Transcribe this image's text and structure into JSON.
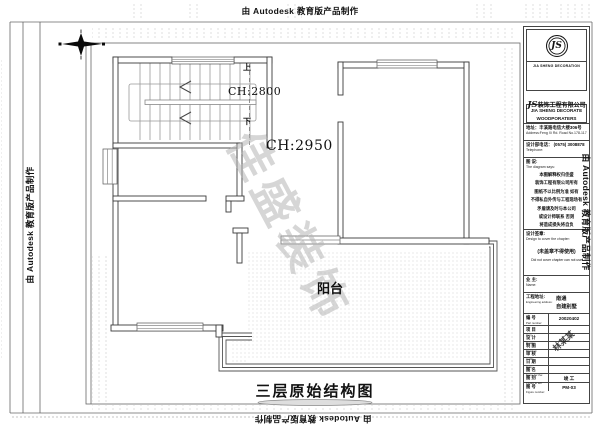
{
  "page": {
    "plot_stamp": "由 Autodesk 教育版产品制作",
    "drawing_title": "三层原始结构图"
  },
  "plan": {
    "stair_ceiling_height": "CH:2800",
    "main_ceiling_height": "CH:2950",
    "balcony_label": "阳台",
    "stair_up": "上",
    "stair_down": "下",
    "watermark": "佳盛装饰"
  },
  "title_block": {
    "logo_monogram": "JS",
    "logo_caption": "JIA SHENG DECORATION",
    "company_cn_prefix": "JS",
    "company_cn": "装饰工程有限公司",
    "company_en_line1": "JIA SHENG DECORATE",
    "company_en_line2": "WOODPORATERS",
    "address_cn": "地址：丰溪路电信大楼306号",
    "address_en": "Address:Feng Xi Rd. Road No.178-117",
    "phone_cn": "设计部电话： (0575) 3008878",
    "phone_en": "Telephone:",
    "notes_title_cn": "图 说:",
    "notes_title_en": "The diagram says:",
    "notes_lines": [
      "本图解释权归佳盛",
      "装饰工程有限公司所有",
      "图纸不以比例为准 如有",
      "不得私自外传与工程现场有",
      "矛盾请及时与本公司",
      "或设计师联系 否则",
      "将造成损失将自负"
    ],
    "seal_label_cn": "设计签章:",
    "seal_label_en": "Design to cover the chapter:",
    "seal_warning_cn": "(未盖章不得使用)",
    "seal_warning_en": "Did not cover chapter can not use",
    "owner_label_cn": "业 主:",
    "owner_label_en": "Name:",
    "site_label_cn": "工程地址:",
    "site_label_en": "Engineering address:",
    "site_value_line1": "南通",
    "site_value_line2": "自建别墅",
    "rows": [
      {
        "label_cn": "编 号",
        "label_en": "Part number:",
        "value": "20020402"
      },
      {
        "label_cn": "项 目",
        "label_en": "Item:",
        "value": ""
      },
      {
        "label_cn": "设 计",
        "label_en": "Design:",
        "value": ""
      },
      {
        "label_cn": "制 图",
        "label_en": "Drawing:",
        "value": ""
      },
      {
        "label_cn": "审 核",
        "label_en": "Audit:",
        "value": ""
      },
      {
        "label_cn": "日 期",
        "label_en": "Date:",
        "value": ""
      },
      {
        "label_cn": "图 名",
        "label_en": "Name for the:",
        "value": ""
      },
      {
        "label_cn": "图 别",
        "label_en": "Figure to tell:",
        "value": "竣 工"
      },
      {
        "label_cn": "图 号",
        "label_en": "Figure number:",
        "value": "PM-03"
      }
    ],
    "signature_stamp": "林某某"
  }
}
